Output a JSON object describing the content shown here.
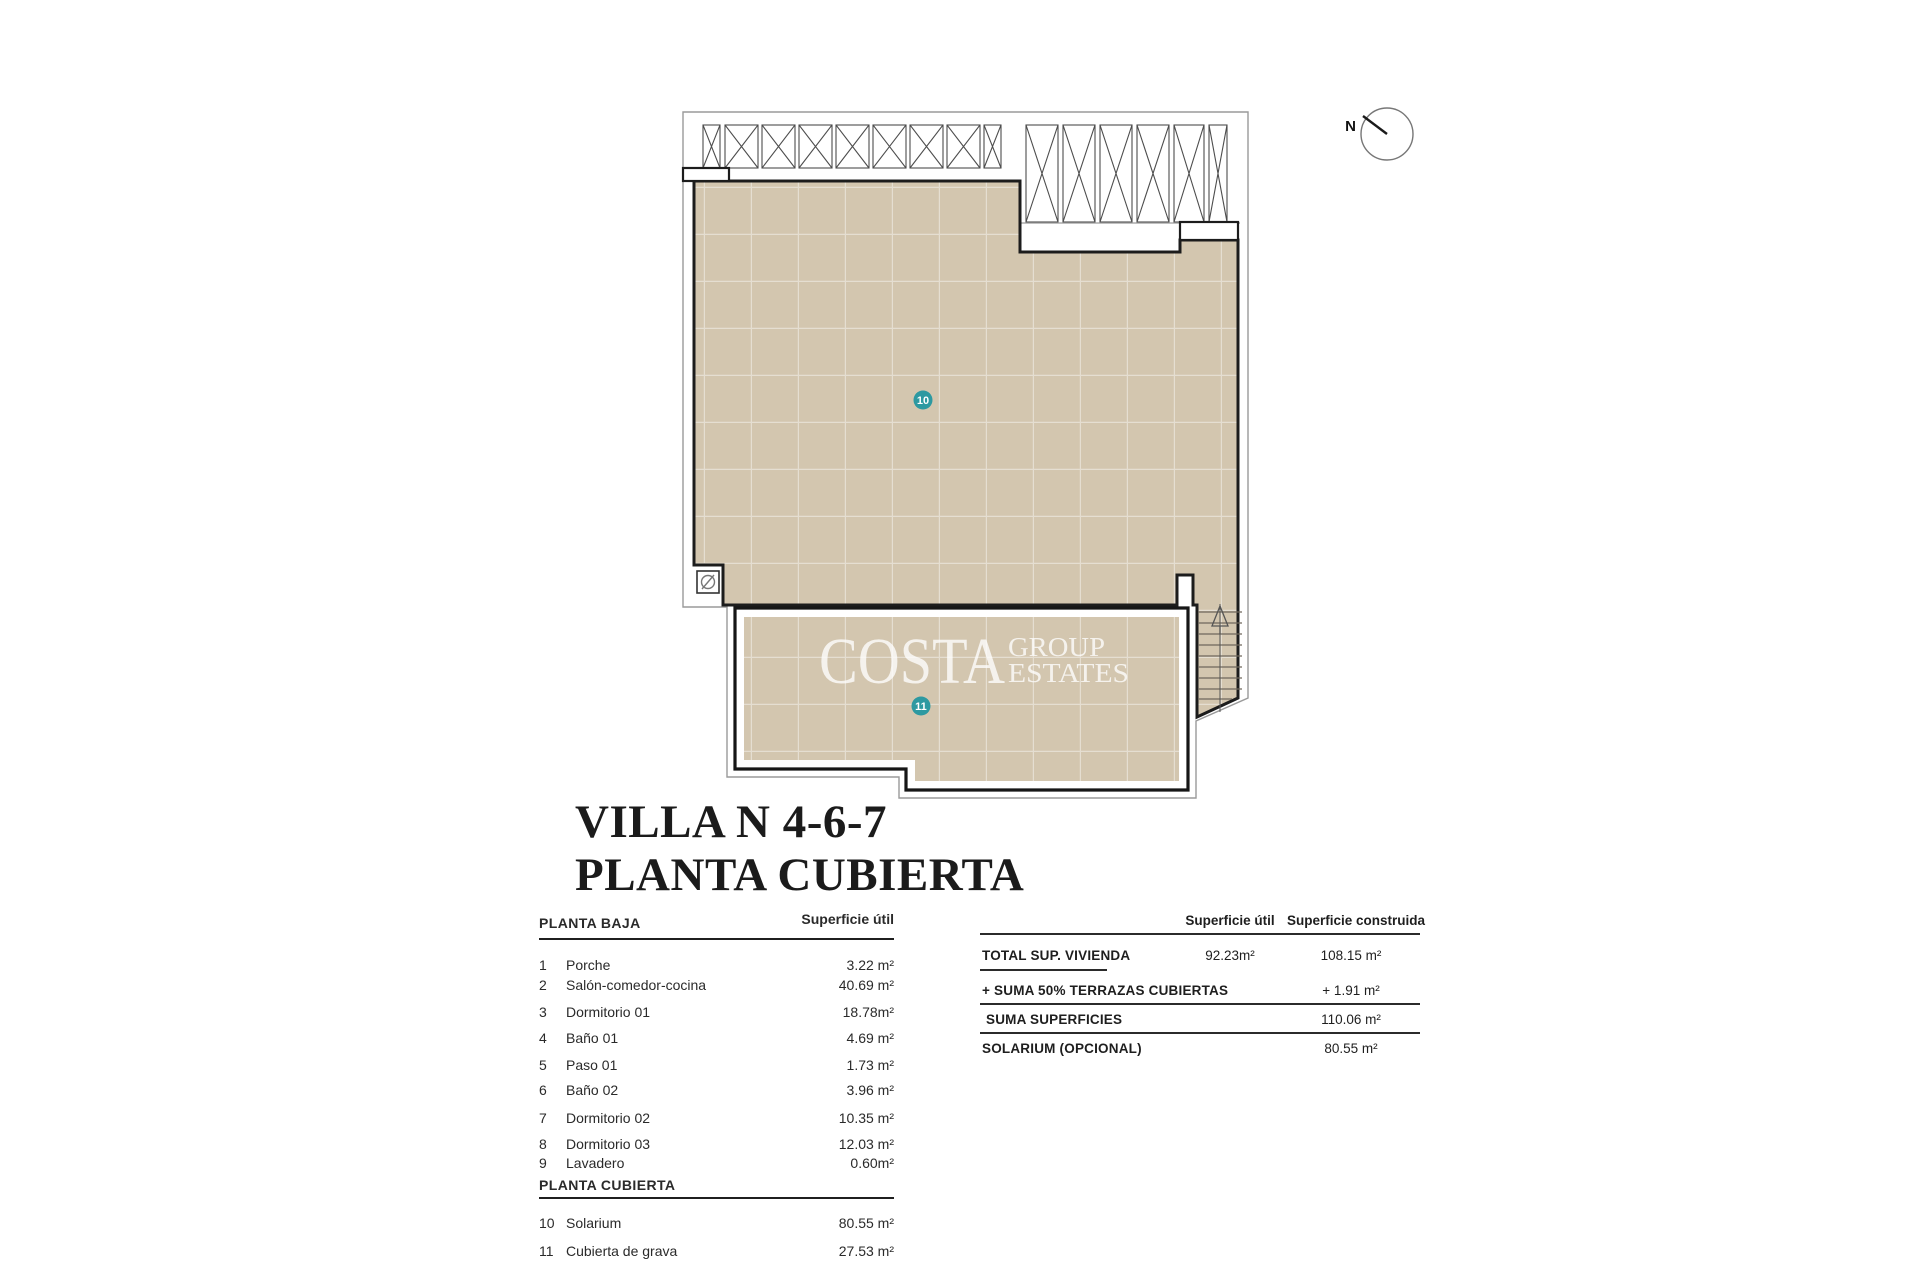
{
  "title": {
    "line1": "VILLA N 4-6-7",
    "line2": "PLANTA CUBIERTA"
  },
  "plan": {
    "compass_label": "N",
    "watermark": {
      "word1": "COSTA",
      "word2": "GROUP",
      "word3": "ESTATES"
    },
    "markers": [
      {
        "label": "10"
      },
      {
        "label": "11"
      }
    ]
  },
  "left_table": {
    "section1_title": "PLANTA BAJA",
    "area_col_header": "Superficie útil",
    "rows_planta_baja": [
      {
        "num": "1",
        "name": "Porche",
        "value": "3.22 m²"
      },
      {
        "num": "2",
        "name": "Salón-comedor-cocina",
        "value": "40.69 m²"
      },
      {
        "num": "3",
        "name": "Dormitorio 01",
        "value": "18.78m²"
      },
      {
        "num": "4",
        "name": "Baño 01",
        "value": "4.69 m²"
      },
      {
        "num": "5",
        "name": "Paso 01",
        "value": "1.73 m²"
      },
      {
        "num": "6",
        "name": "Baño 02",
        "value": "3.96 m²"
      },
      {
        "num": "7",
        "name": "Dormitorio 02",
        "value": "10.35 m²"
      },
      {
        "num": "8",
        "name": "Dormitorio 03",
        "value": "12.03 m²"
      },
      {
        "num": "9",
        "name": "Lavadero",
        "value": "0.60m²"
      }
    ],
    "section2_title": "PLANTA CUBIERTA",
    "rows_planta_cubierta": [
      {
        "num": "10",
        "name": "Solarium",
        "value": "80.55 m²"
      },
      {
        "num": "11",
        "name": "Cubierta de grava",
        "value": "27.53 m²"
      }
    ]
  },
  "right_table": {
    "col1_header": "Superficie útil",
    "col2_header": "Superficie construida",
    "rows": [
      {
        "label": "TOTAL SUP. VIVIENDA",
        "util": "92.23m²",
        "construida": "108.15 m²"
      },
      {
        "label": "+ SUMA 50% TERRAZAS CUBIERTAS",
        "util": "",
        "construida": "+ 1.91 m²"
      },
      {
        "label": "SUMA SUPERFICIES",
        "util": "",
        "construida": "110.06 m²"
      },
      {
        "label": "SOLARIUM (OPCIONAL)",
        "util": "",
        "construida": "80.55 m²"
      }
    ]
  },
  "colors": {
    "roof_fill": "#d3c6af",
    "marker_teal": "#2d99a1",
    "outline": "#1c1c1c"
  }
}
